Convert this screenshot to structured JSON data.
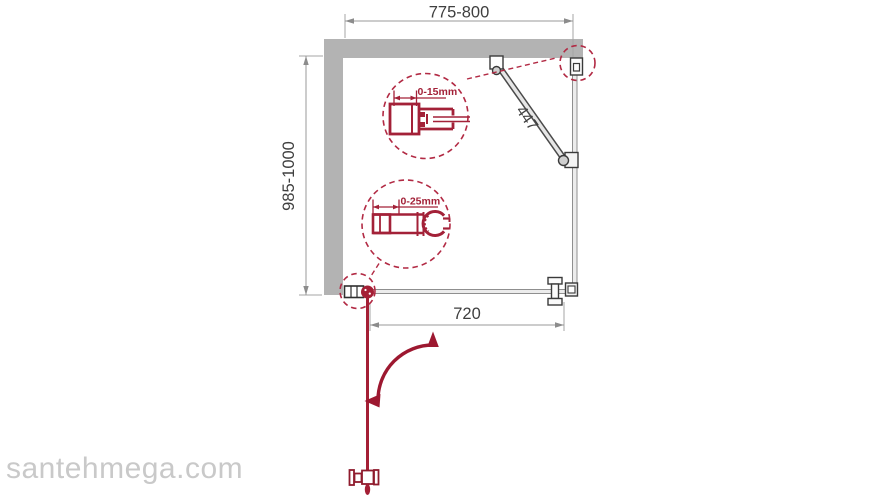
{
  "dimensions": {
    "width_top": "775-800",
    "depth_left": "985-1000",
    "door_bottom": "720",
    "support_bar": "447"
  },
  "details": {
    "wall_profile_adjustment": "0-15mm",
    "glass_holder_adjustment": "0-25mm"
  },
  "watermark": "santehmega.com",
  "colors": {
    "accent_red": "#a32138",
    "dashed_red": "#b22a44",
    "wall_gray": "#b3b3b3",
    "dimension_gray": "#8c8c8c",
    "text_dark": "#3f3f3f",
    "watermark_gray": "#c9c9c9"
  }
}
